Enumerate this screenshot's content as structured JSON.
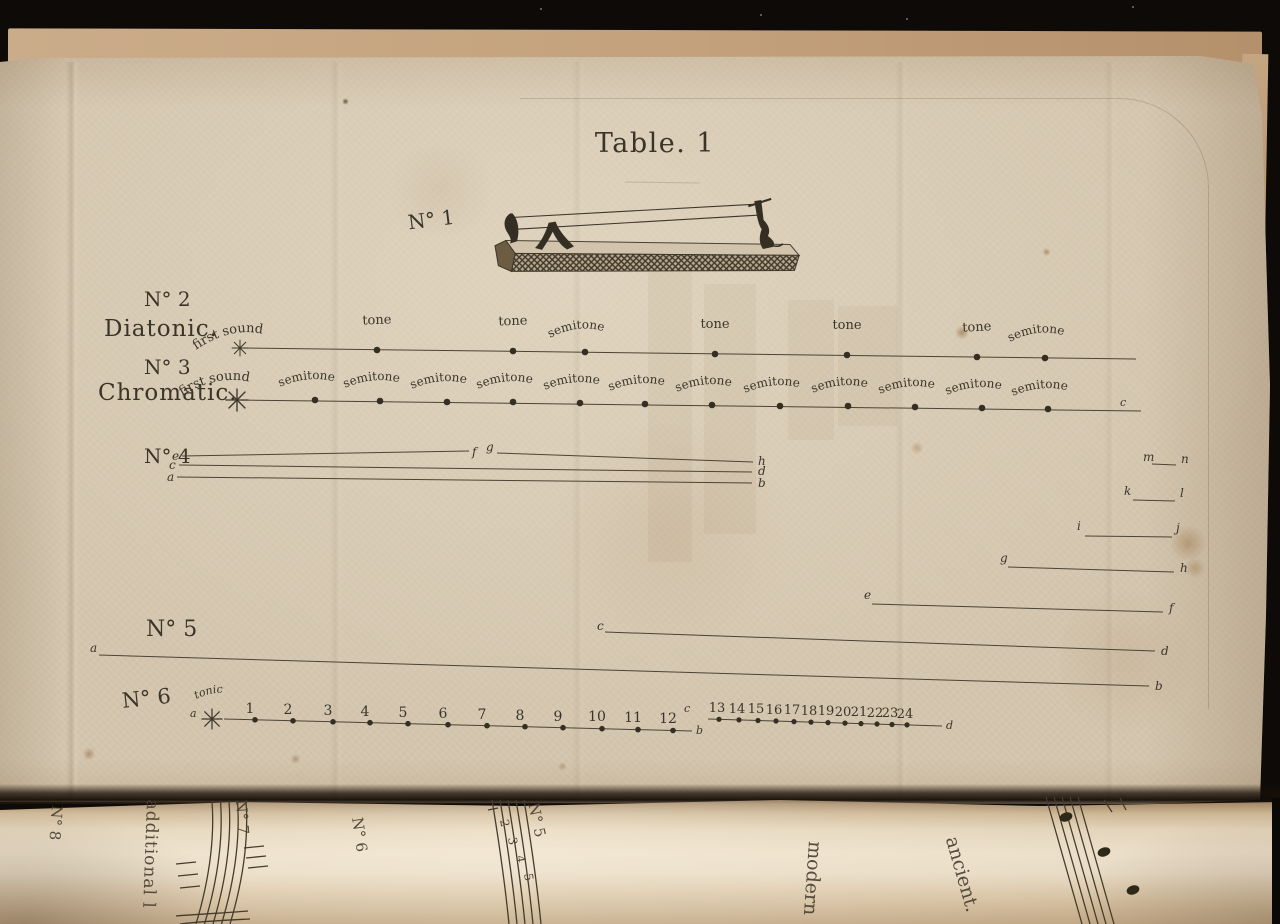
{
  "title": "Table. 1",
  "fig1": {
    "label": "N° 1"
  },
  "fig2": {
    "label": "N° 2",
    "name": "Diatonic.",
    "first_sound": "first sound",
    "marker": "*",
    "intervals": [
      "tone",
      "tone",
      "semitone",
      "tone",
      "tone",
      "tone",
      "semitone"
    ]
  },
  "fig3": {
    "label": "N° 3",
    "name": "Chromatic.",
    "first_sound": "first sound",
    "marker": "*",
    "intervals": [
      "semitone",
      "semitone",
      "semitone",
      "semitone",
      "semitone",
      "semitone",
      "semitone",
      "semitone",
      "semitone",
      "semitone",
      "semitone",
      "semitone"
    ],
    "end_letter": "c"
  },
  "fig4": {
    "label": "N° 4",
    "left_letters": [
      "e",
      "c",
      "a"
    ],
    "mid_letters": [
      "f",
      "g"
    ],
    "end_letters": [
      "h",
      "d",
      "b"
    ],
    "right_segments": [
      {
        "start": "m",
        "end": "n"
      },
      {
        "start": "k",
        "end": "l"
      },
      {
        "start": "i",
        "end": "j"
      },
      {
        "start": "g",
        "end": "h"
      },
      {
        "start": "e",
        "end": "f"
      }
    ]
  },
  "fig5": {
    "label": "N° 5",
    "lines": [
      {
        "start": "c",
        "end": "d"
      },
      {
        "start": "a",
        "end": "b"
      }
    ]
  },
  "fig6": {
    "label": "N° 6",
    "start_letter": "a",
    "tonic": "tonic",
    "marker": "*",
    "numbers_first": [
      "1",
      "2",
      "3",
      "4",
      "5",
      "6",
      "7",
      "8",
      "9",
      "10",
      "11",
      "12"
    ],
    "mid_top": "c",
    "mid_bottom": "b",
    "numbers_second": [
      "13",
      "14",
      "15",
      "16",
      "17",
      "18",
      "19",
      "20",
      "21",
      "22",
      "23",
      "24"
    ],
    "end_letter": "d"
  },
  "verso": {
    "no8": "N° 8",
    "additional": "additional l",
    "no7": "N° 7",
    "no6": "N° 6",
    "no5": "N° 5",
    "staff_numbers": [
      "2",
      "3",
      "4",
      "5"
    ],
    "modern": "modern",
    "ancient": "ancient."
  },
  "colors": {
    "paper": "#d5c7b0",
    "ink": "#3b3529",
    "background": "#0d0a07",
    "verso_paper": "#e8dbc5"
  }
}
